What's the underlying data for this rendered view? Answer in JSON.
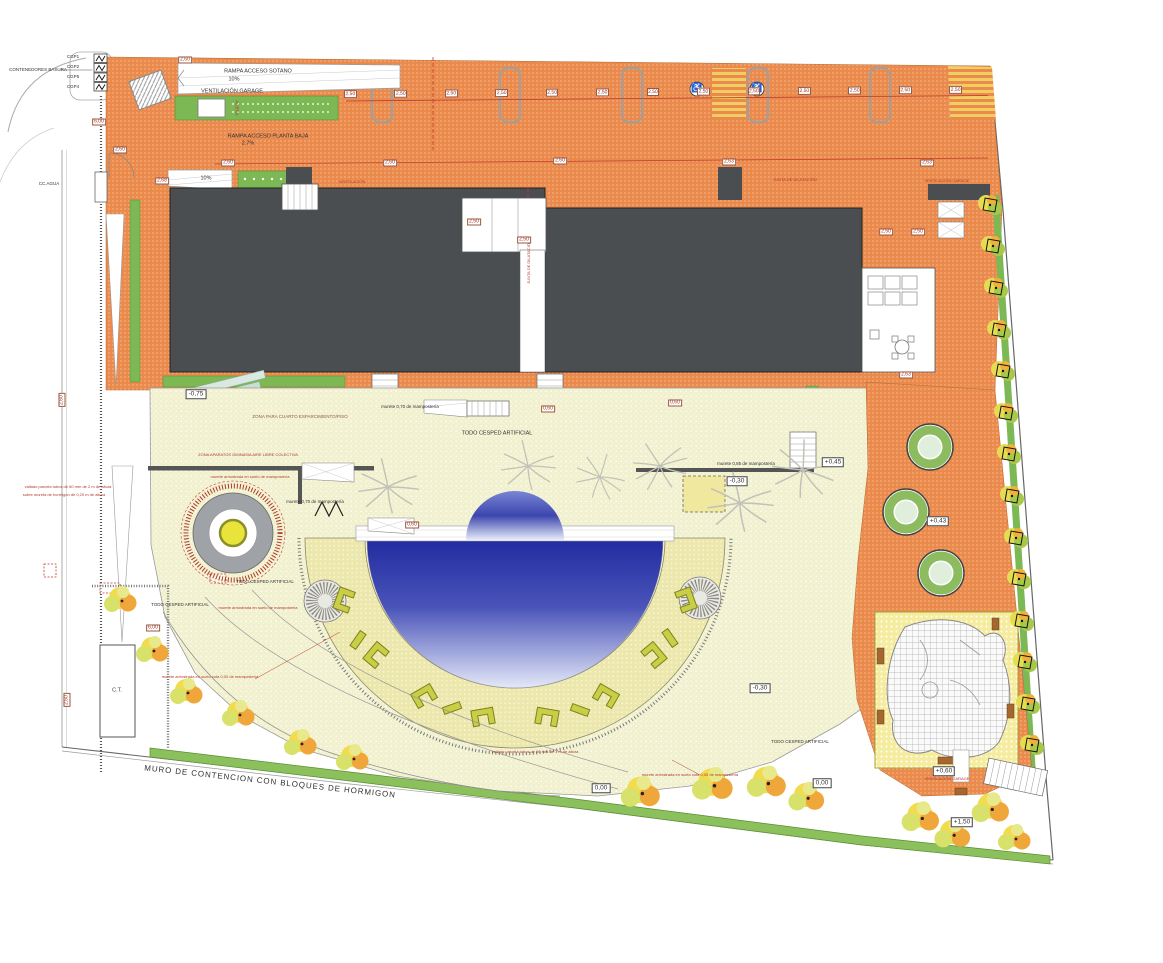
{
  "plan": {
    "title": "Plano de urbanización / site plan",
    "labels": {
      "contenedores": "CONTENEDORES BASURA",
      "cgp1": "CGP1",
      "cgp2": "CGP2",
      "cgp3": "CGP5",
      "cgp4": "CGP4",
      "acera": "ACERA",
      "rampa_sotano": "RAMPA ACCESO SOTANO",
      "rampa_sotano_pct": "10%",
      "vent_garage": "VENTILACIÓN GARAGE",
      "rampa_pb": "RAMPA ACCESO PLANTA BAJA",
      "rampa_pb_pct": "2.7%",
      "rampa10": "10%",
      "ccagua": "CC.AGUA",
      "ventilacion": "VENTILACIÓN",
      "junta": "JUNTA DE DILATACIÓN",
      "zona_cuarto": "ZONA PARA CUARTO ESPARCIMIENTO/PISO",
      "zona_aparatos": "ZONA APARATOS GIMNASIA AIRE LIBRE COLECTIVA",
      "murete_suelo": "murete arriostrada en suelo de mampostería",
      "murete_cota": "murete arriostrada en suelo cota 0,00 de mampostería",
      "murete070": "murete 0,70 de mampostería",
      "murete085": "murete 0,85 de mampostería",
      "cesped": "TODO CESPED ARTIFICIAL",
      "vallado2m_1": "vallado parcela tubos de 60 mm de 2 m de altura",
      "vallado2m_2": "sobre mureta de hormigon de 0,20 m de altura",
      "vallado1m": "vallado parcela tubos de 60 mm de 1 m de altura",
      "muro": "MURO DE CONTENCION  CON BLOQUES DE HORMIGON",
      "ct": "C.T."
    },
    "levels": {
      "m075": "-0,75",
      "m030": "-0,30",
      "p045": "+0,45",
      "p043": "+0,43",
      "p060": "+0,60",
      "p150": "+1,50",
      "zero": "0,00"
    },
    "dims": {
      "stall": "2,50",
      "d250": "2,50",
      "d260": "2,60",
      "d263": "2,63",
      "d268": "2,68",
      "d600": "6,00",
      "d060": "0,60"
    },
    "icons": {
      "handicap": "♿"
    },
    "colors": {
      "orange": "#EA8A4C",
      "cream": "#F1F1CF",
      "building": "#4A4E50",
      "green": "#7CB854",
      "pool_dark": "#232CA0",
      "pool_light": "#E4E8F8",
      "bench": "#C9CE45",
      "annotation_red": "#B03A2E"
    }
  }
}
